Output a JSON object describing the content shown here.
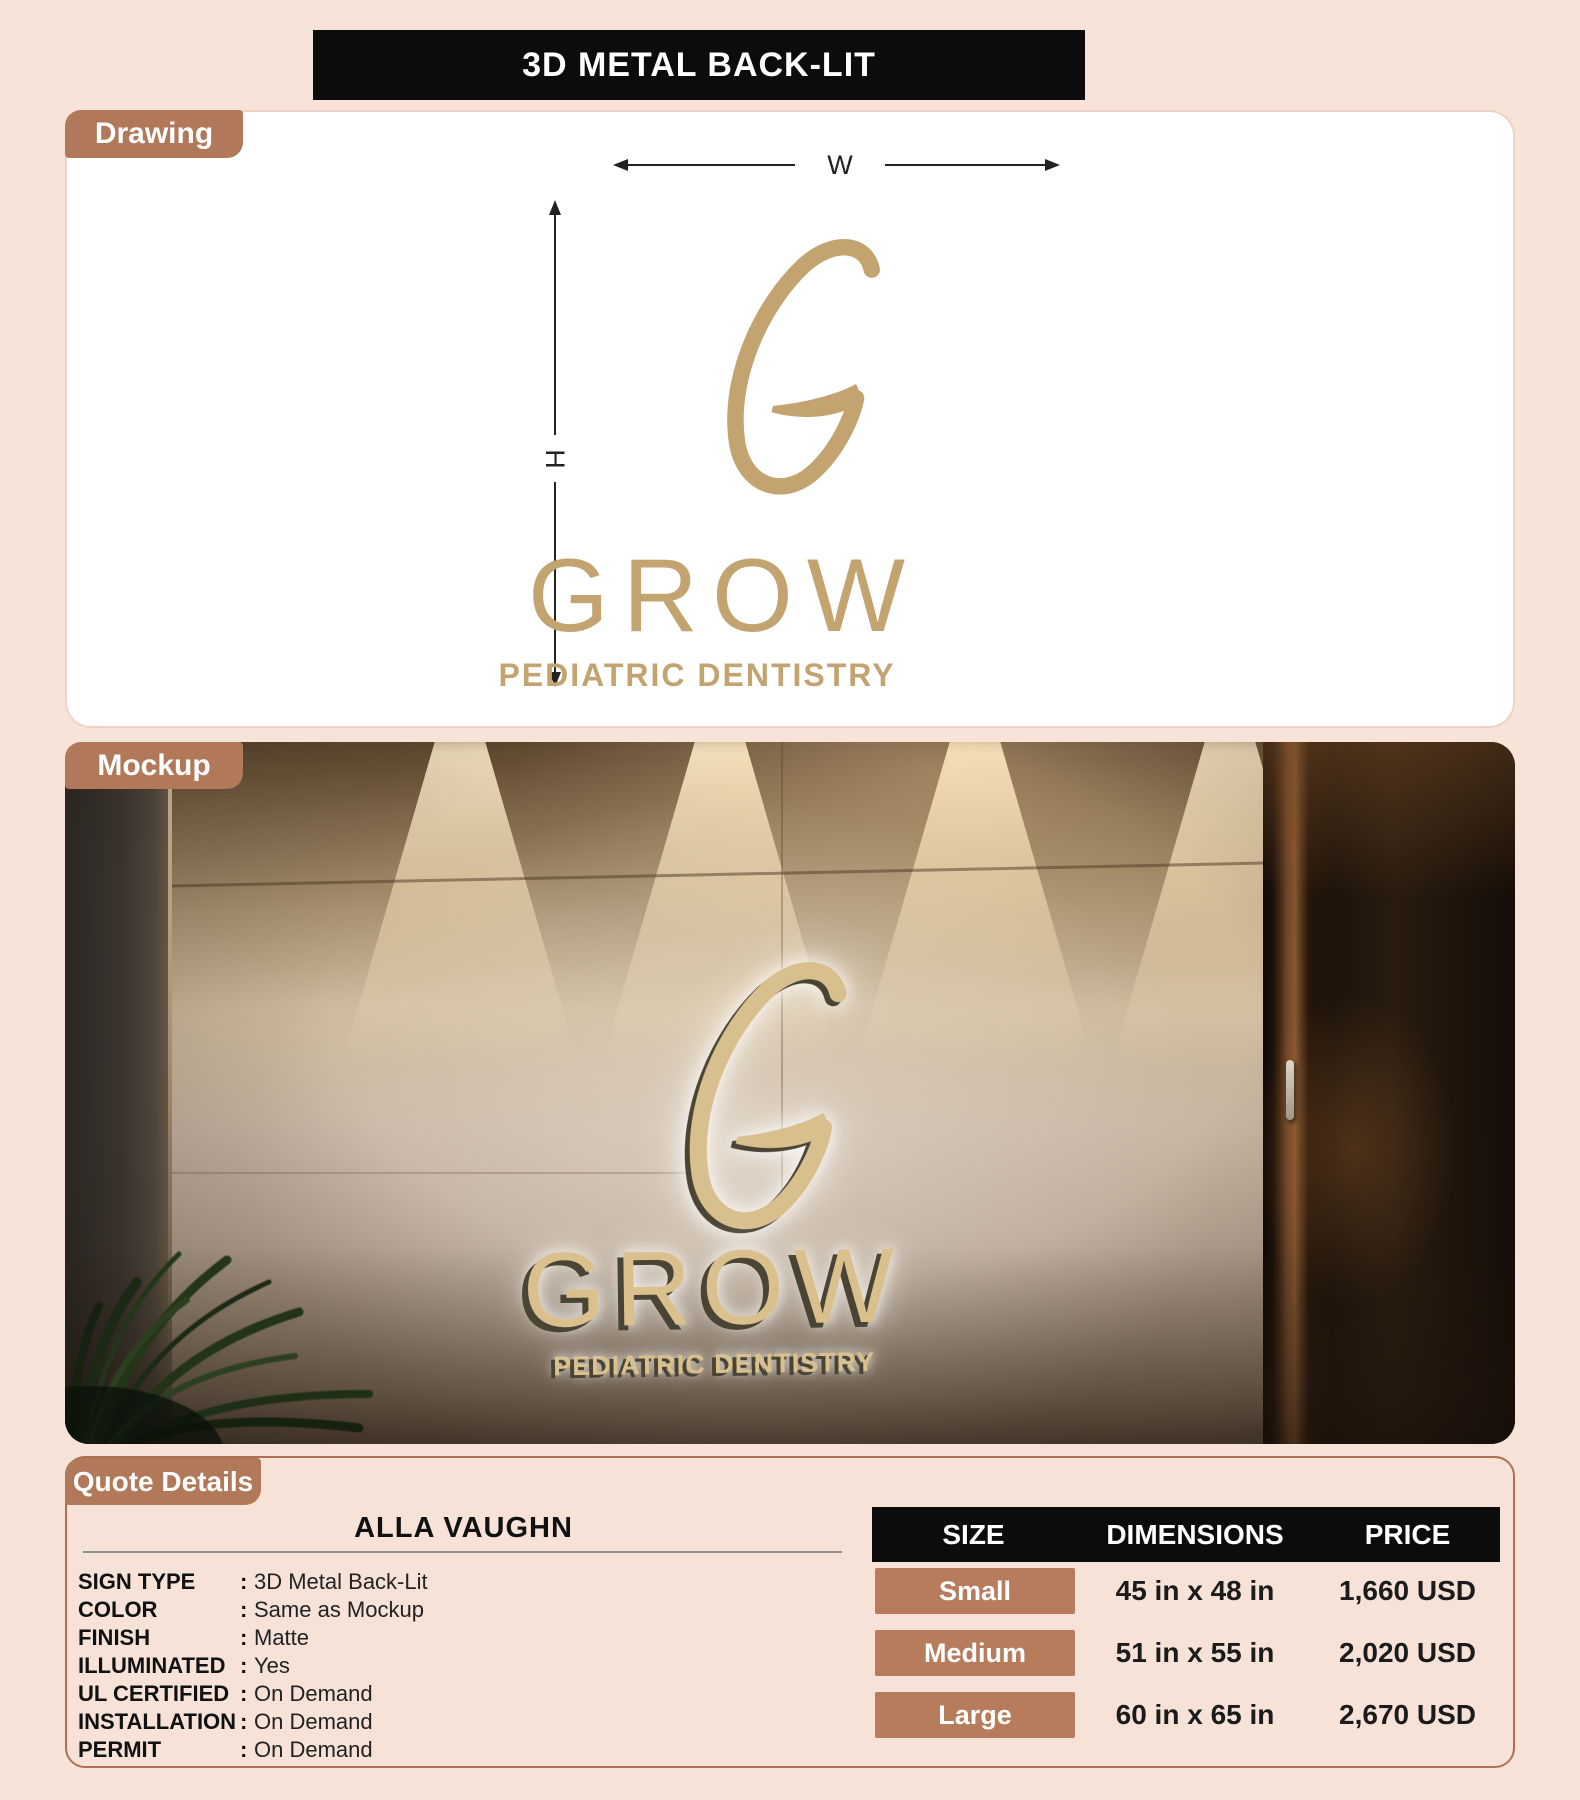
{
  "page": {
    "title": "3D METAL BACK-LIT"
  },
  "tabs": {
    "drawing": "Drawing",
    "mockup": "Mockup",
    "quote": "Quote Details"
  },
  "logo": {
    "monogram": "G",
    "wordmark": "GROW",
    "tagline": "PEDIATRIC DENTISTRY"
  },
  "drawing": {
    "width_label": "W",
    "height_label": "H"
  },
  "quote": {
    "customer_name": "ALLA VAUGHN",
    "colon": ":",
    "specs": [
      {
        "label": "SIGN TYPE",
        "value": "3D Metal Back-Lit"
      },
      {
        "label": "COLOR",
        "value": "Same as Mockup"
      },
      {
        "label": "FINISH",
        "value": "Matte"
      },
      {
        "label": "ILLUMINATED",
        "value": "Yes"
      },
      {
        "label": "UL CERTIFIED",
        "value": "On Demand"
      },
      {
        "label": "INSTALLATION",
        "value": "On Demand"
      },
      {
        "label": "PERMIT",
        "value": "On Demand"
      }
    ],
    "pricing": {
      "headers": [
        "SIZE",
        "DIMENSIONS",
        "PRICE"
      ],
      "rows": [
        {
          "size": "Small",
          "dimensions": "45 in x 48 in",
          "price": "1,660 USD"
        },
        {
          "size": "Medium",
          "dimensions": "51 in x 55 in",
          "price": "2,020 USD"
        },
        {
          "size": "Large",
          "dimensions": "60 in x 65 in",
          "price": "2,670 USD"
        }
      ]
    }
  },
  "colors": {
    "background": "#f7e3d8",
    "accent_brown": "#b1785a",
    "chip_brown": "#b67c5c",
    "gold_drawing": "#c3a470",
    "gold_mockup": "#d9c08d",
    "table_header_bg": "#0c0c0c"
  }
}
